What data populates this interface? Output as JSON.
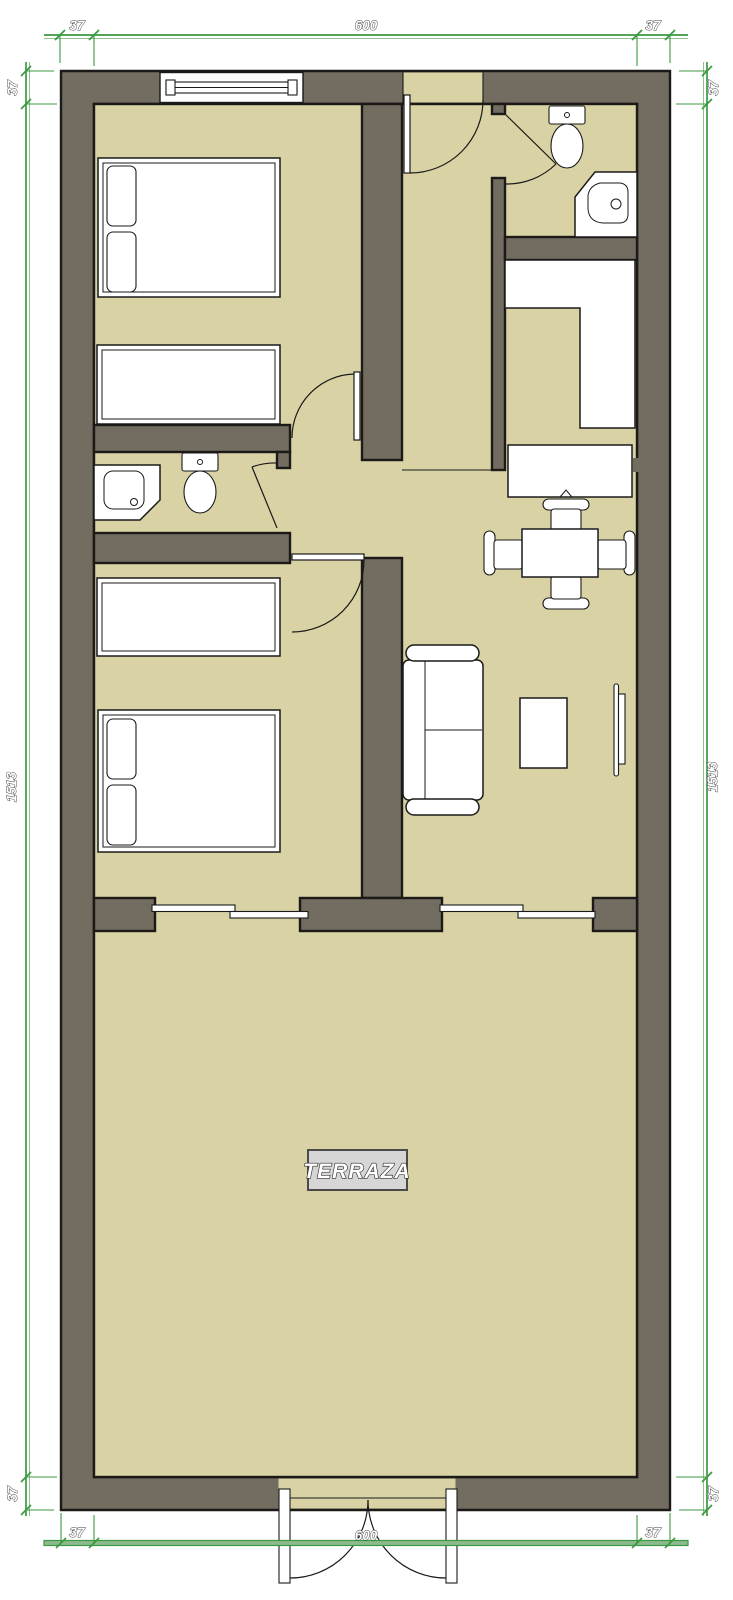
{
  "floor_plan": {
    "room_labels": {
      "terrace": "TERRAZA"
    },
    "dimensions": {
      "top": [
        "37",
        "600",
        "37"
      ],
      "bottom": [
        "37",
        "600",
        "37"
      ],
      "left": [
        "37",
        "1513",
        "37"
      ],
      "right": [
        "37",
        "1513",
        "37"
      ]
    },
    "colors": {
      "floor": "#d8d2a4",
      "wall_fill": "#736c61",
      "wall_outline": "#1c1a17",
      "dimension_green": "#3a9a3f",
      "dimension_band": "#8cba8e",
      "furniture": "#ffffff",
      "label_box": "#d6d6d6",
      "label_text": "#ffffff"
    },
    "furniture_icons": [
      "double-bed",
      "single-bed",
      "pillow",
      "toilet",
      "corner-sink",
      "corner-shower",
      "kitchen-counter",
      "desk",
      "dining-table",
      "chair",
      "sofa",
      "coffee-table",
      "tv",
      "hinged-door",
      "sliding-door",
      "french-door",
      "window"
    ]
  }
}
